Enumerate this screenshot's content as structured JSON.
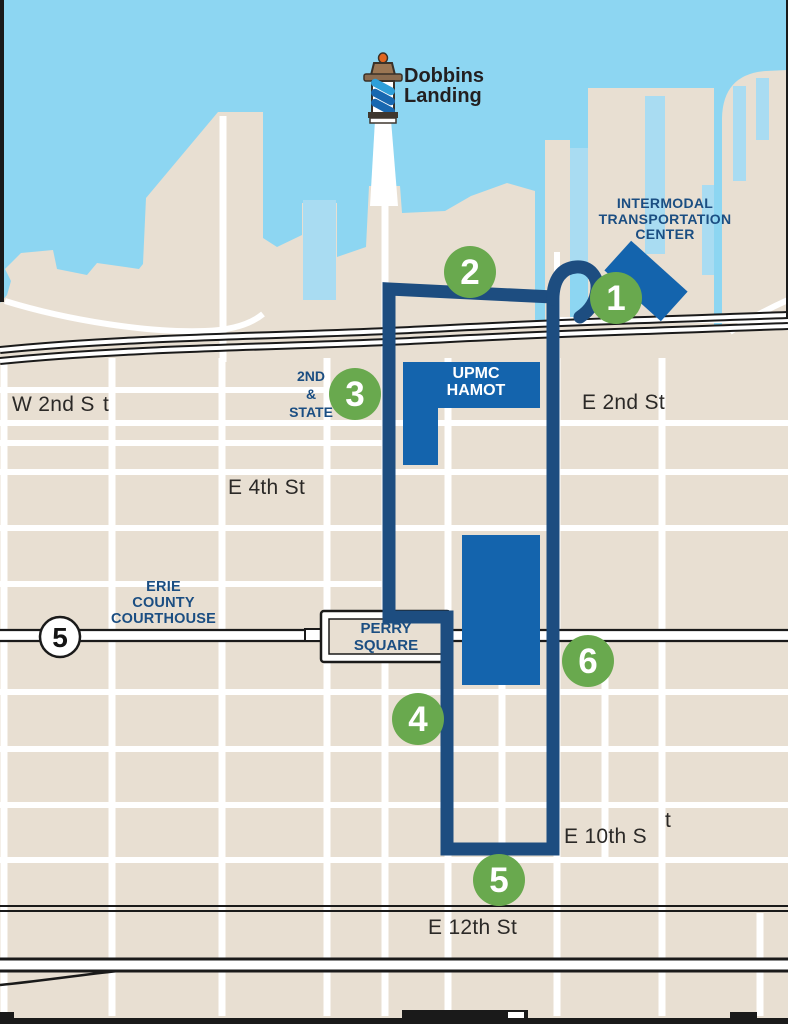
{
  "map": {
    "title": "Erie bayfront trolley route map",
    "poi": {
      "dobbins": {
        "line1": "Dobbins",
        "line2": "Landing"
      },
      "itc": {
        "line1": "INTERMODAL",
        "line2": "TRANSPORTATION",
        "line3": "CENTER"
      },
      "second_state": {
        "line1": "2ND",
        "line2": "&",
        "line3": "STATE"
      },
      "upmc": {
        "line1": "UPMC",
        "line2": "HAMOT"
      },
      "courthouse": {
        "line1": "ERIE",
        "line2": "COUNTY",
        "line3": "COURTHOUSE"
      },
      "perry": {
        "line1": "PERRY",
        "line2": "SQUARE"
      }
    },
    "streets": {
      "w2nd": {
        "part1": "W 2nd S",
        "part2": "t"
      },
      "e2nd": "E 2nd St",
      "e4th": "E 4th St",
      "e10th": {
        "part1": "E 10th S",
        "part2": "t"
      },
      "e12th": "E 12th St"
    },
    "route_shield": "5",
    "markers": [
      {
        "number": "1"
      },
      {
        "number": "2"
      },
      {
        "number": "3"
      },
      {
        "number": "4"
      },
      {
        "number": "5"
      },
      {
        "number": "6"
      }
    ],
    "colors": {
      "water": "#8dd6f2",
      "land": "#e8dfd2",
      "slip": "#a9dcf2",
      "street": "#ffffff",
      "route": "#1d4d80",
      "building": "#1464ad",
      "marker_green": "#69a94e",
      "navy_text": "#1b4e82",
      "dark_text": "#231f20"
    }
  }
}
